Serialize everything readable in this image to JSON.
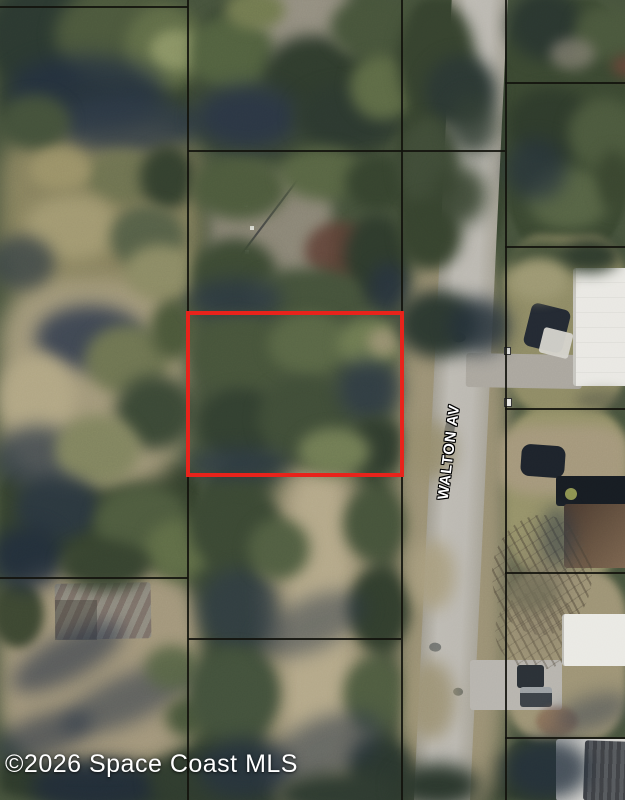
{
  "image": {
    "type": "aerial-parcel-map-photo",
    "street_label": "WALTON AV",
    "watermark": "©2026 Space Coast MLS"
  },
  "colors": {
    "boundary-red": "#e8231b",
    "parcel-line": "#12120d",
    "road-gray": "#b7b4ad",
    "street-label-fill": "#ffffff",
    "street-label-outline": "#000000",
    "watermark-fill": "#ffffff"
  }
}
